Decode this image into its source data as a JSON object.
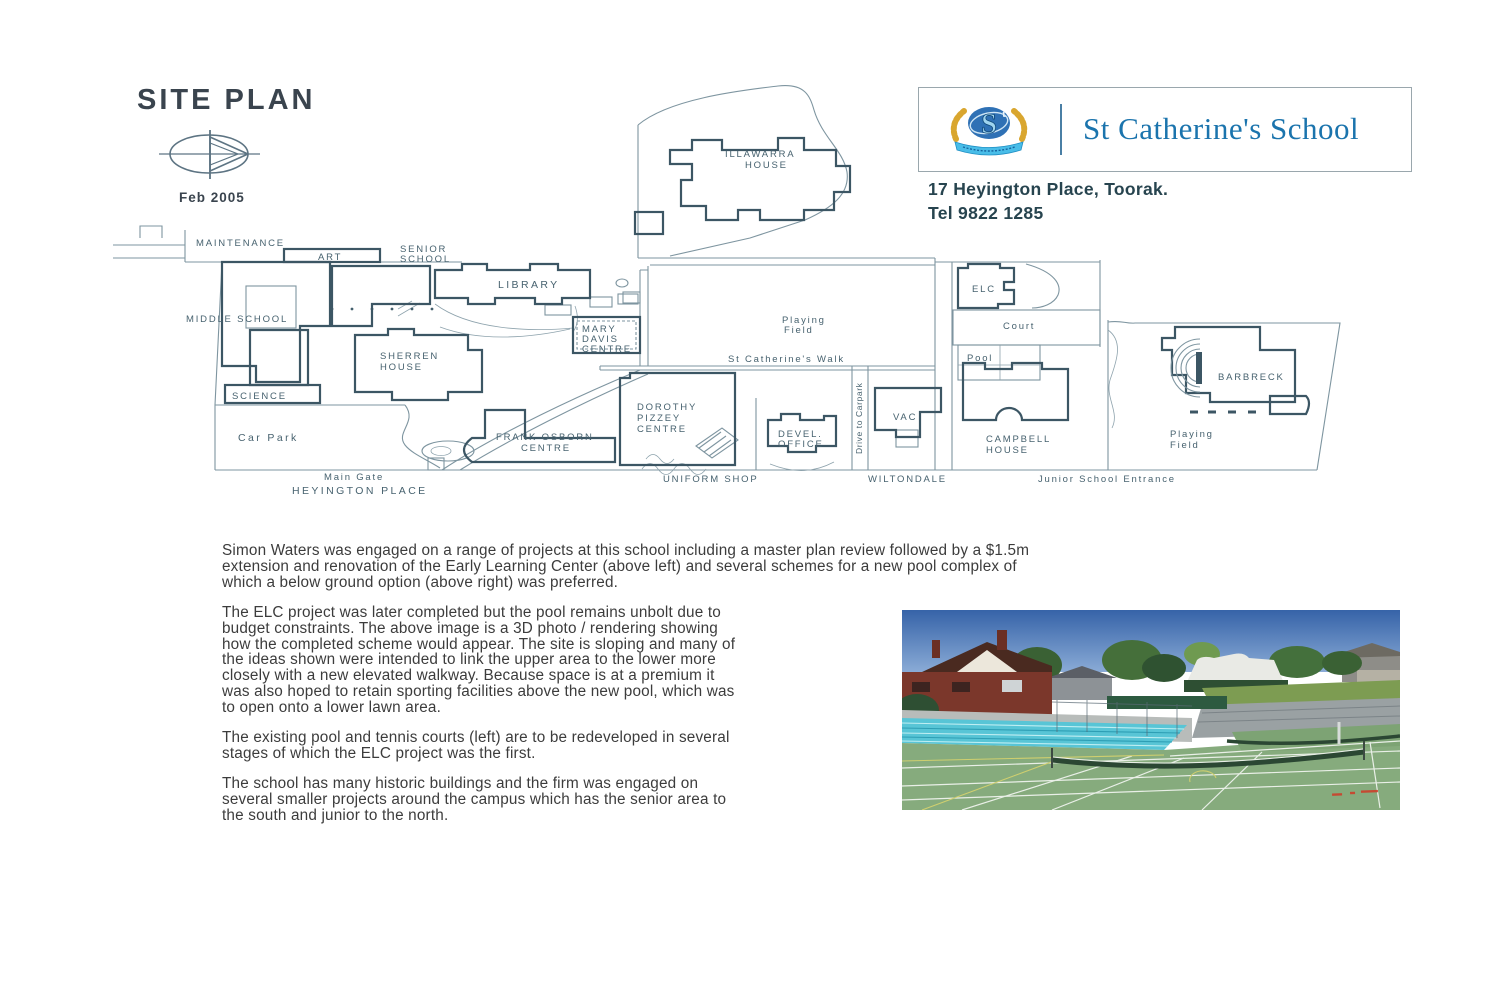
{
  "page": {
    "title": "SITE PLAN",
    "date_label": "Feb 2005"
  },
  "header": {
    "school_name": "St Catherine's School",
    "address_line": "17 Heyington Place, Toorak.",
    "phone_line": "Tel  9822 1285",
    "name_color": "#1b74ad",
    "crest_monogram": "S",
    "crest_monogram_small": "t"
  },
  "plan": {
    "line_color": "#3c5664",
    "labels": {
      "maintenance": "MAINTENANCE",
      "art": "ART",
      "senior_school": [
        "SENIOR",
        "SCHOOL"
      ],
      "library": "LIBRARY",
      "middle_school": "MIDDLE SCHOOL",
      "mary_davis": [
        "MARY",
        "DAVIS",
        "CENTRE"
      ],
      "sherren_house": [
        "SHERREN",
        "HOUSE"
      ],
      "science": "SCIENCE",
      "car_park": "Car Park",
      "main_gate": "Main Gate",
      "heyington_place": "HEYINGTON PLACE",
      "frank_osborn": [
        "FRANK OSBORN",
        "CENTRE"
      ],
      "dorothy_pizzey": [
        "DOROTHY",
        "PIZZEY",
        "CENTRE"
      ],
      "uniform_shop": "UNIFORM SHOP",
      "devel_office": [
        "DEVEL.",
        "OFFICE"
      ],
      "drive_to_carpark": "Drive to Carpark",
      "vac": "VAC",
      "wiltondale": "WILTONDALE",
      "illawarra_house": [
        "ILLAWARRA",
        "HOUSE"
      ],
      "playing_field_left": [
        "Playing",
        "Field"
      ],
      "st_catherines_walk": "St Catherine's Walk",
      "elc": "ELC",
      "court": "Court",
      "pool": "Pool",
      "campbell_house": [
        "CAMPBELL",
        "HOUSE"
      ],
      "junior_school_entrance": "Junior School Entrance",
      "barbreck": "BARBRECK",
      "playing_field_right": [
        "Playing",
        "Field"
      ]
    }
  },
  "body": {
    "paragraphs": [
      [
        "Simon Waters was engaged on a range of projects at this school including a master plan review followed by a $1.5m",
        "extension and renovation of the Early Learning Center (above left) and several schemes for a new pool complex of",
        "which a below ground option (above right) was preferred."
      ],
      [
        "The ELC project was later completed but the pool remains unbolt due to",
        "budget constraints. The above image is a 3D photo / rendering showing",
        "how the completed scheme would appear. The site is sloping and many of",
        "the ideas shown were intended to link the upper area to the lower more",
        "closely with a new elevated walkway. Because space is at a premium it",
        "was also hoped to retain sporting facilities above the new pool, which was",
        "to open onto a lower lawn area."
      ],
      [
        "The existing pool and tennis courts (left) are to be redeveloped in several",
        "stages of which the ELC project was the first."
      ],
      [
        "The school has many historic buildings and the firm was engaged on",
        "several smaller projects around the campus which has the senior area to",
        "the south and junior to the north."
      ]
    ]
  },
  "photo": {
    "subject": "existing pool and tennis courts",
    "colors": {
      "sky": "#3663a8",
      "pool": "#58c5d6",
      "court": "#86ab7d",
      "grass": "#7d9c52",
      "stamp_red": "#d03a25"
    }
  }
}
